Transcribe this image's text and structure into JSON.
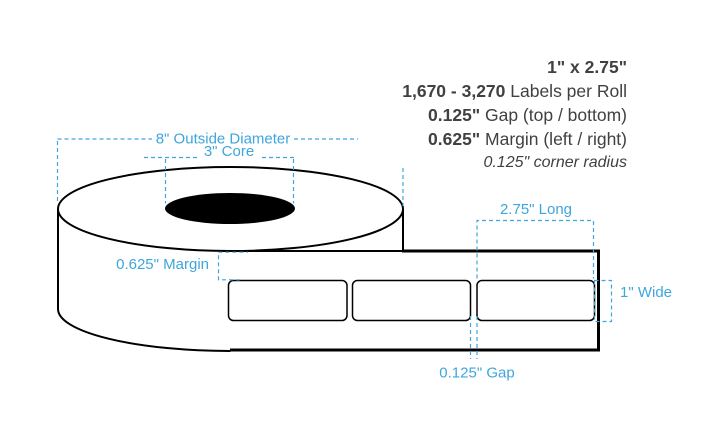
{
  "specs": {
    "title": "1\" x 2.75\"",
    "rows": [
      {
        "bold": "1,670 - 3,270",
        "rest": " Labels per Roll"
      },
      {
        "bold": "0.125\"",
        "rest": " Gap (top / bottom)"
      },
      {
        "bold": "0.625\"",
        "rest": " Margin (left / right)"
      }
    ],
    "note": "0.125\" corner radius"
  },
  "annotations": {
    "outside_diameter": "8\" Outside Diameter",
    "core": "3\" Core",
    "margin": "0.625\" Margin",
    "long": "2.75\" Long",
    "wide": "1\" Wide",
    "gap": "0.125\" Gap"
  },
  "colors": {
    "annotation_blue": "#3FA6DC",
    "text_dark": "#414042",
    "line_black": "#000000"
  }
}
